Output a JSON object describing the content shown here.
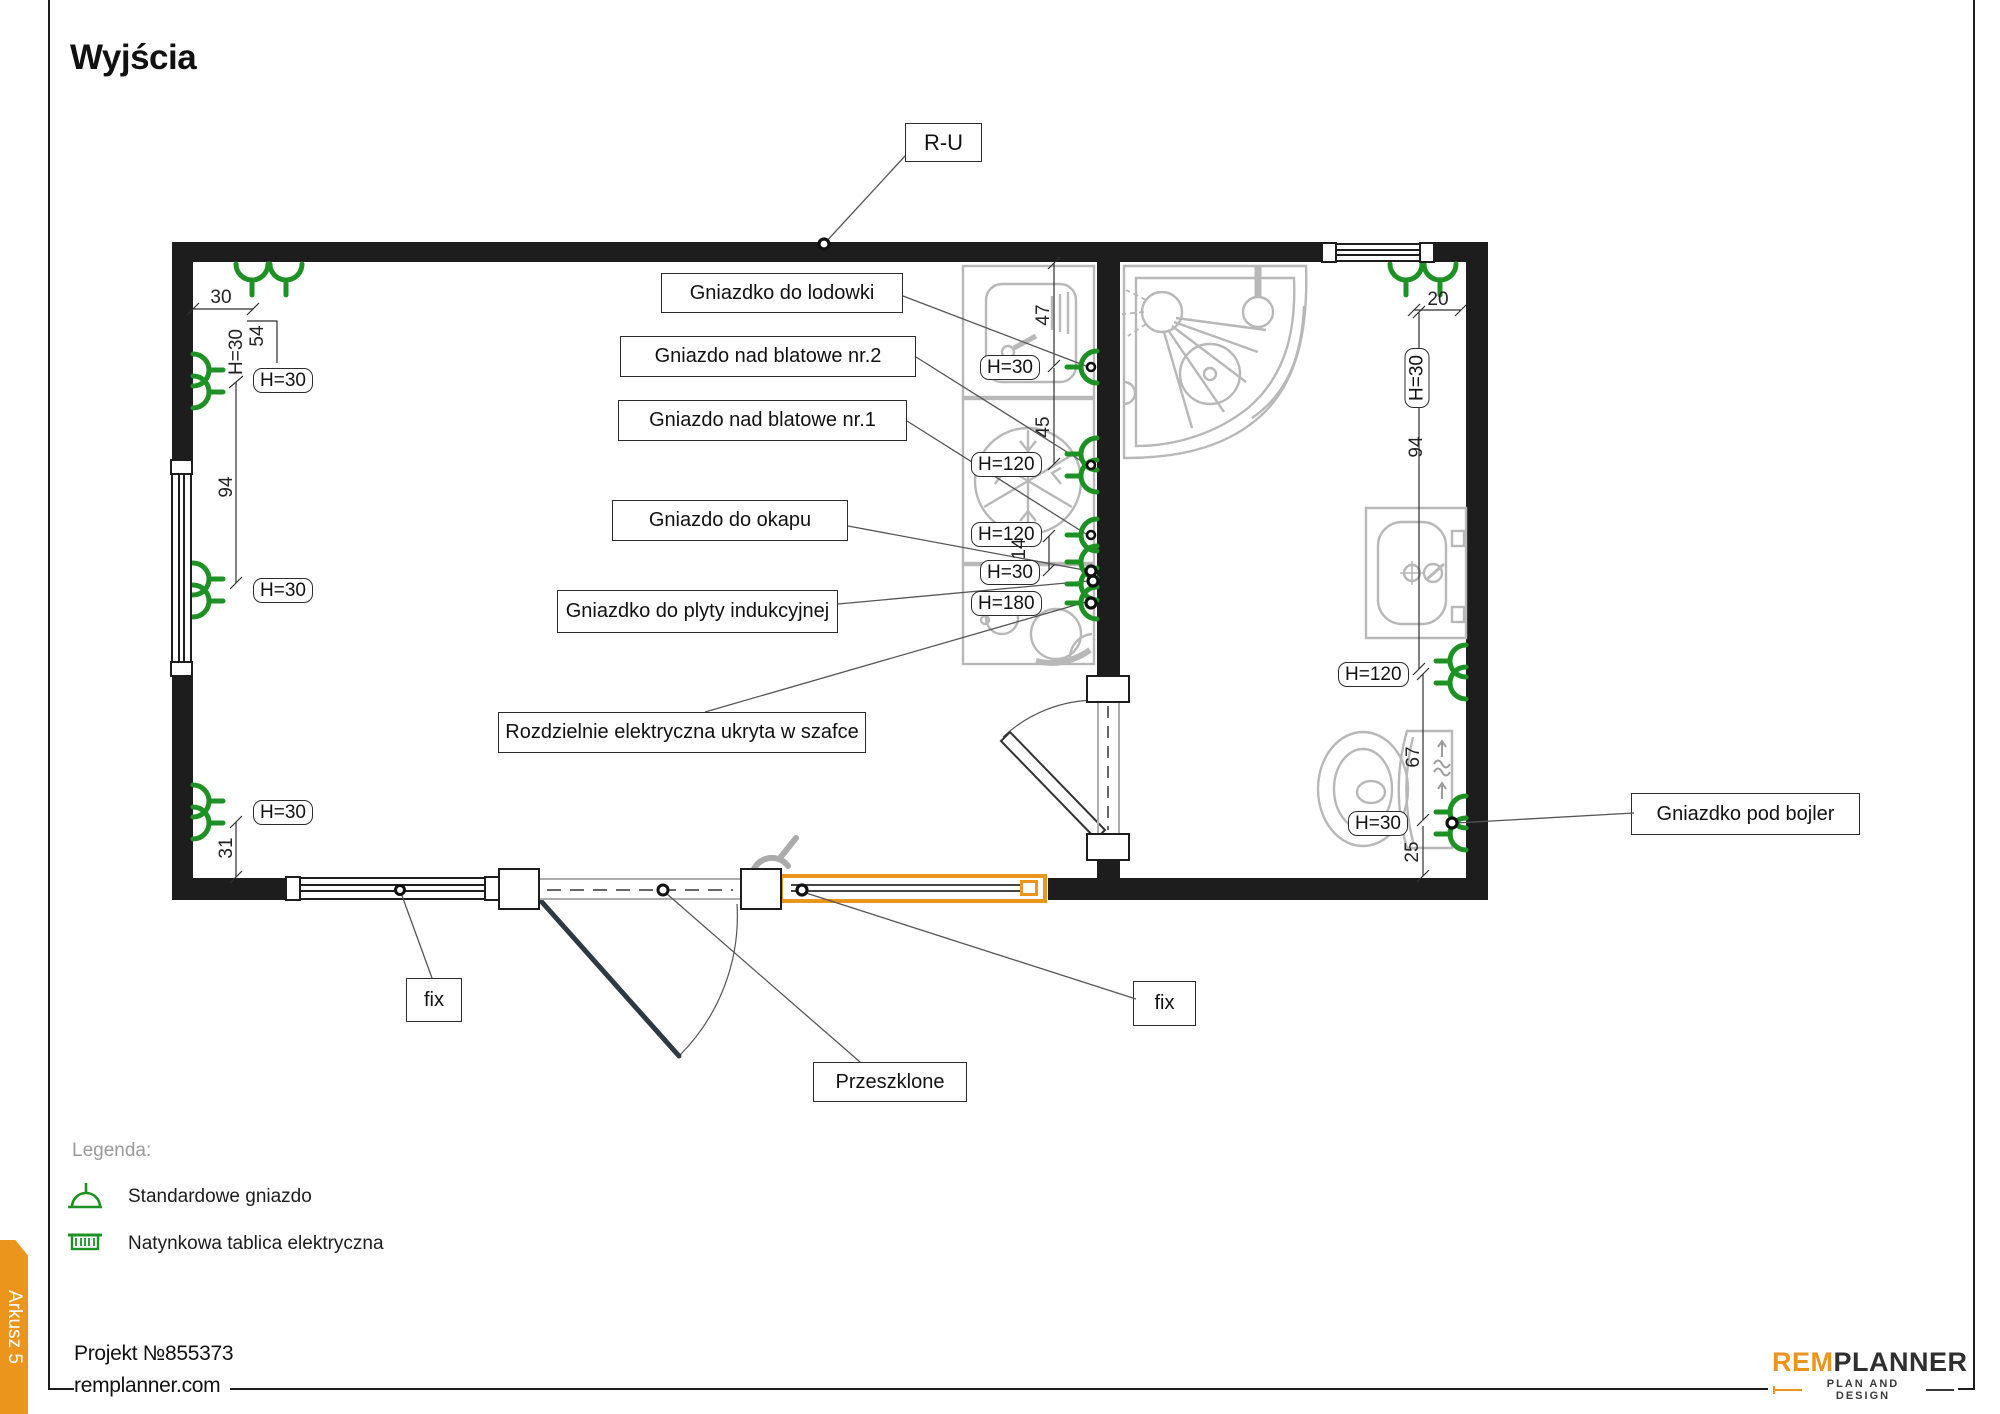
{
  "title": "Wyjścia",
  "plan": {
    "ru_label": "R-U",
    "callouts": {
      "lodowki": "Gniazdko do lodowki",
      "nad_blatowe_2": "Gniazdo nad blatowe nr.2",
      "nad_blatowe_1": "Gniazdo nad blatowe nr.1",
      "okap": "Gniazdo do okapu",
      "plyta": "Gniazdko do plyty indukcyjnej",
      "rozdzielnia": "Rozdzielnie elektryczna ukryta w szafce",
      "bojler": "Gniazdko pod bojler",
      "fix_left": "fix",
      "fix_right": "fix",
      "przeszklone": "Przeszklone"
    },
    "height_labels": {
      "left_1": "H=30",
      "left_2": "H=30",
      "left_3": "H=30",
      "left_rot": "H=30",
      "kitchen_1": "H=30",
      "kitchen_2": "H=120",
      "kitchen_3": "H=120",
      "kitchen_4": "H=30",
      "kitchen_5": "H=180",
      "bath_1": "H=120",
      "bath_2": "H=30",
      "bath_rot": "H=30"
    },
    "dimensions": {
      "top_left": "30",
      "left_a": "54",
      "left_b": "94",
      "left_c": "31",
      "kitchen_a": "47",
      "kitchen_b": "45",
      "kitchen_c": "14",
      "bath_a": "20",
      "bath_b": "94",
      "bath_c": "67",
      "bath_d": "25"
    }
  },
  "legend": {
    "title": "Legenda:",
    "items": [
      {
        "label": "Standardowe gniazdo"
      },
      {
        "label": "Natynkowa tablica elektryczna"
      }
    ]
  },
  "footer": {
    "project": "Projekt №855373",
    "website": "remplanner.com",
    "sheet_tab": "Arkusz 5"
  },
  "logo": {
    "part1": "REM",
    "part2": "PLANNER",
    "tagline": "PLAN AND DESIGN"
  },
  "colors": {
    "accent": "#EC951C",
    "outlet_green": "#1E9125",
    "wall": "#1D1D1D",
    "fixture_grey": "#B8B8B8"
  }
}
